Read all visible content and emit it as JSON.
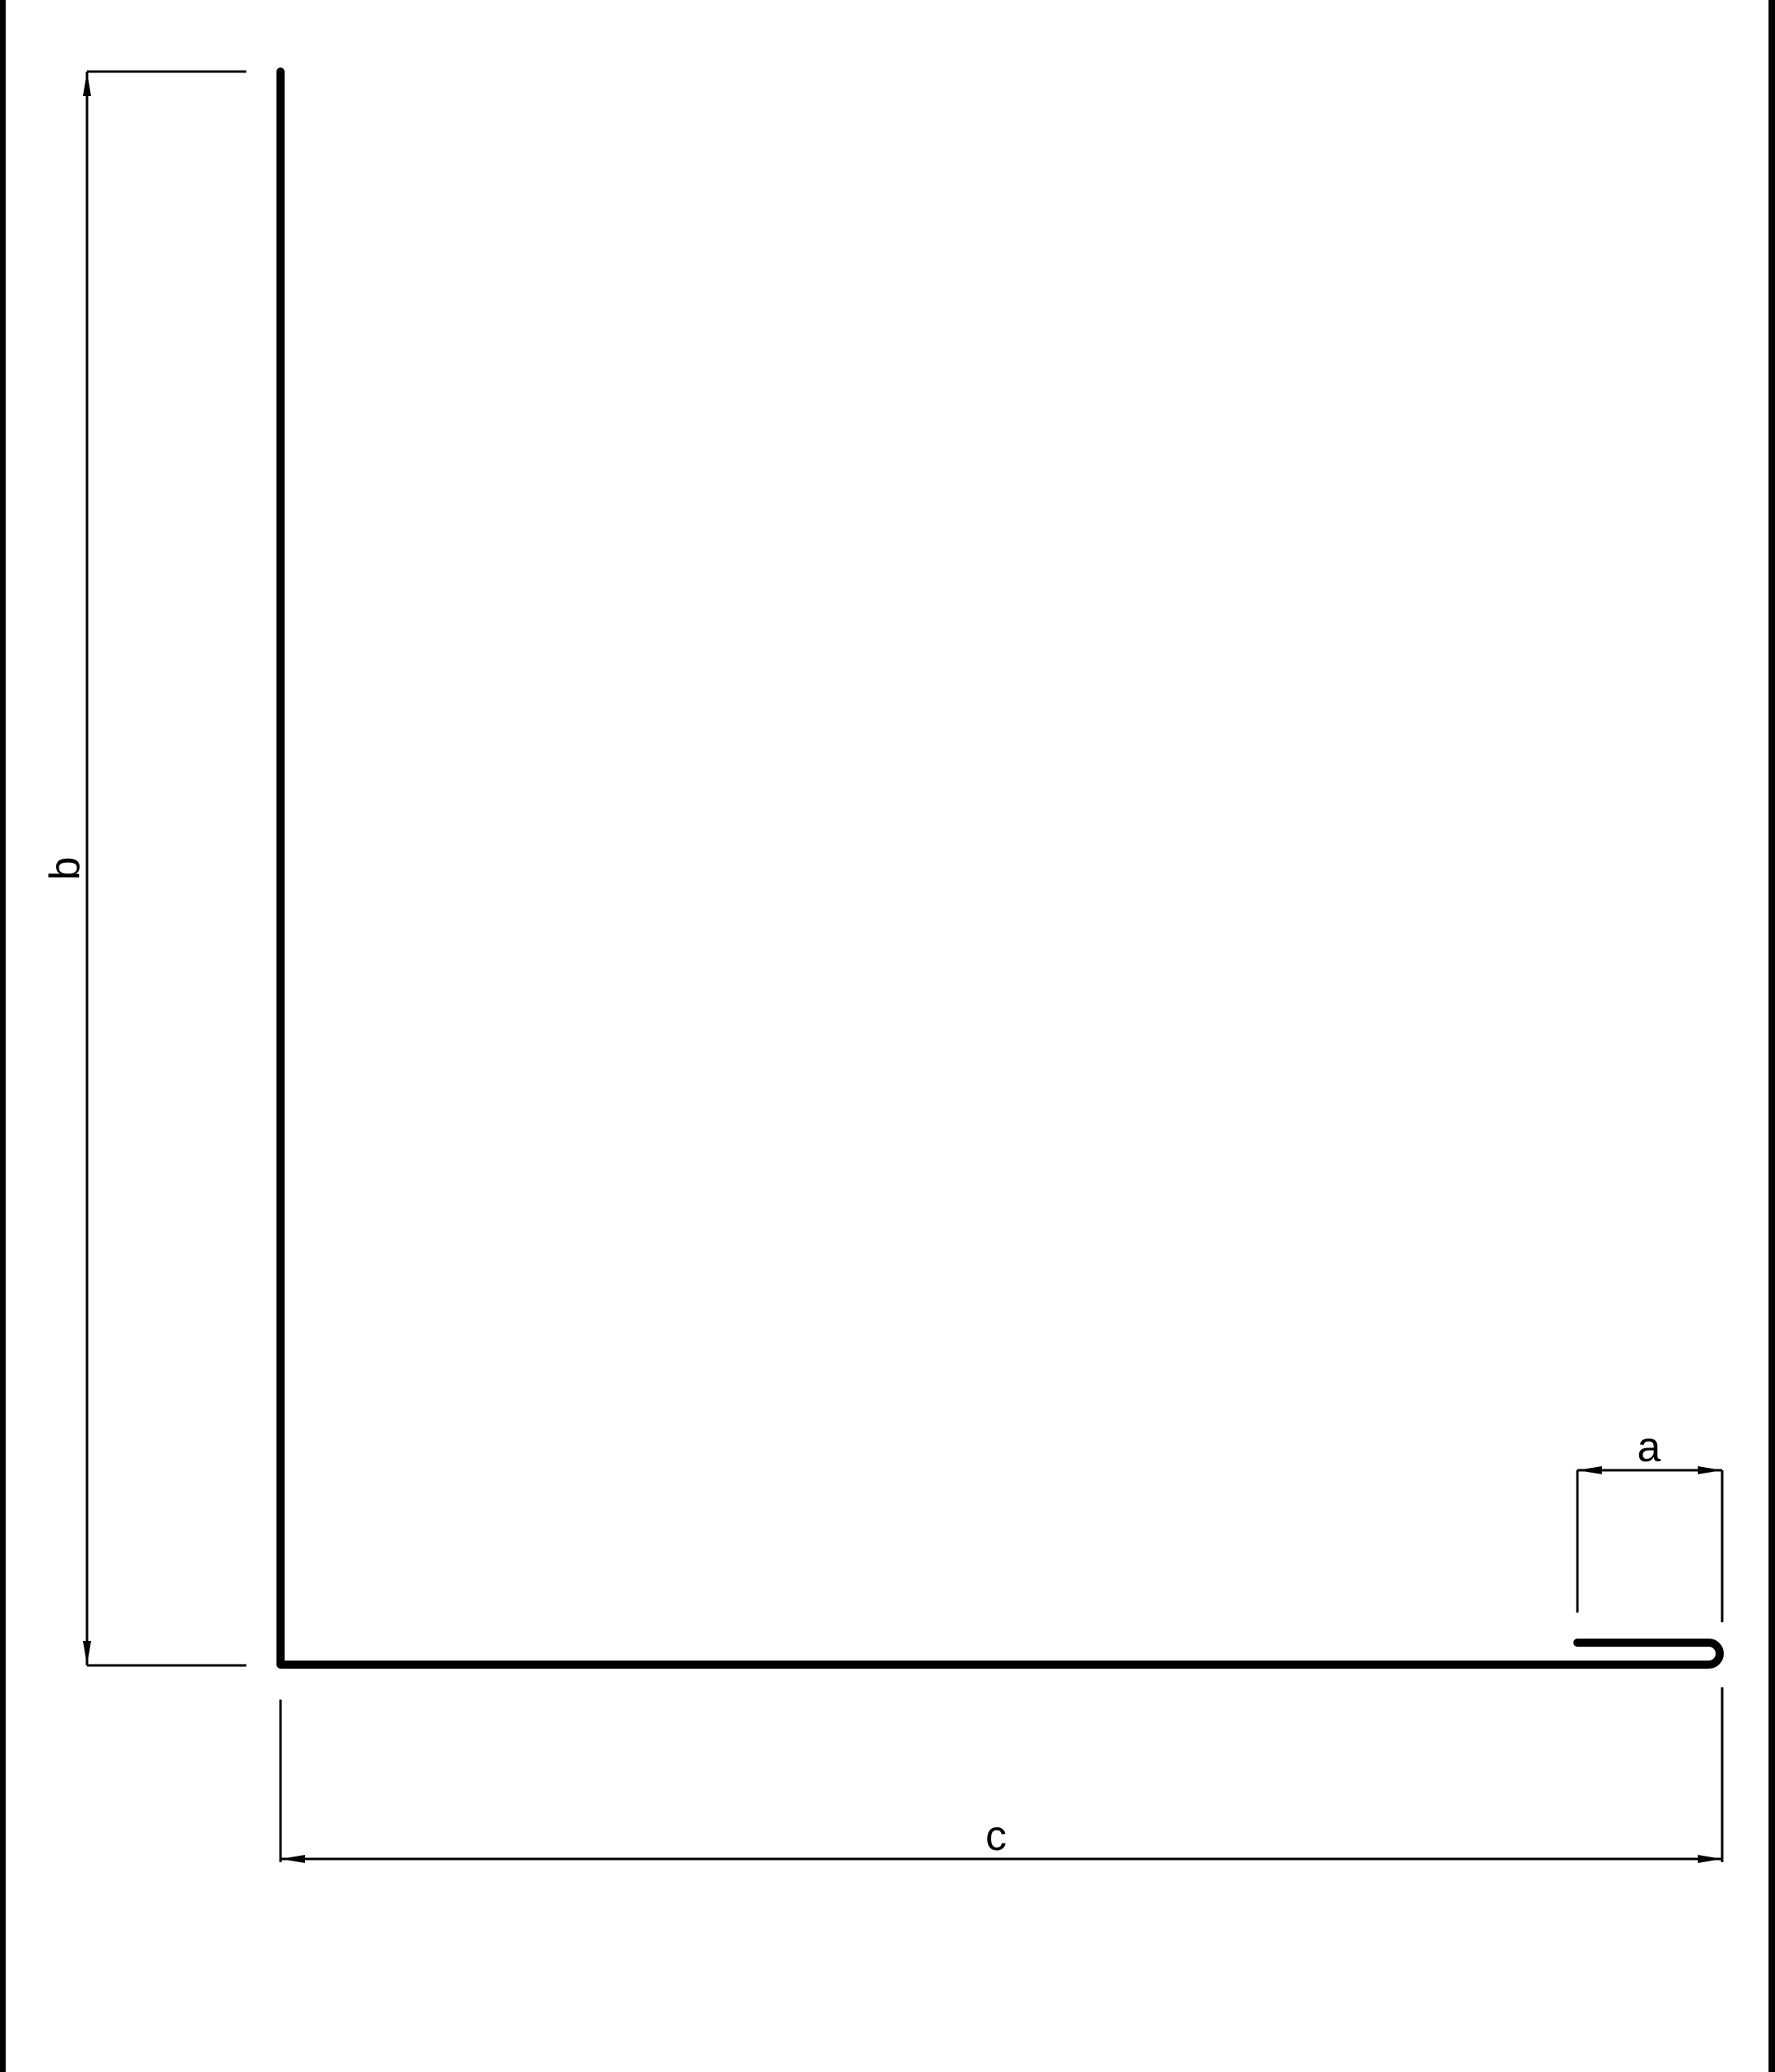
{
  "drawing": {
    "colors": {
      "line": "#000000",
      "background": "#ffffff"
    },
    "dimension_labels": {
      "a": "a",
      "b": "b",
      "c": "c"
    }
  }
}
